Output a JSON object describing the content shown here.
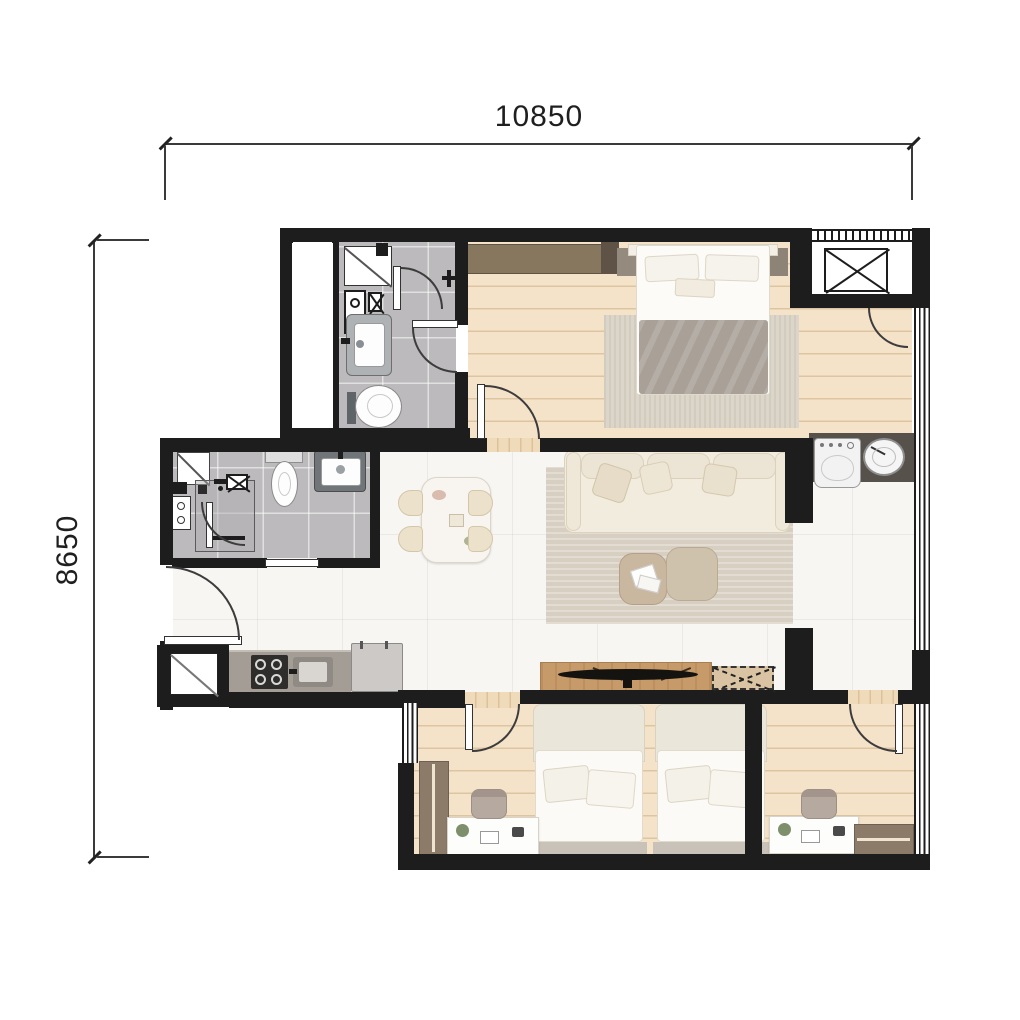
{
  "dimensions": {
    "width_label": "10850",
    "height_label": "8650"
  },
  "plan": {
    "type": "apartment-floor-plan",
    "rooms": [
      {
        "name": "master-bedroom",
        "position": "top-right",
        "floor": "wood",
        "furniture": [
          "wardrobe-with-hangers",
          "double-bed",
          "nightstand-left",
          "nightstand-right",
          "rug",
          "entry-door"
        ]
      },
      {
        "name": "bathroom-1",
        "position": "top-left",
        "floor": "grey-tile",
        "fixtures": [
          "shower-tray",
          "water-heater",
          "shut-off-valve",
          "shower-mixer",
          "wash-basin",
          "toilet",
          "inner-door",
          "entry-door",
          "service-shaft"
        ]
      },
      {
        "name": "ac-ledge",
        "position": "top-right-corner",
        "fixtures": [
          "condenser-unit-x-symbol",
          "louver-grille",
          "access-door"
        ]
      },
      {
        "name": "laundry-nook",
        "position": "right",
        "fixtures": [
          "washing-machine",
          "round-basin",
          "dark-counter"
        ]
      },
      {
        "name": "living-dining",
        "position": "center",
        "floor": "white-tile",
        "furniture": [
          "dining-table",
          "dining-chairs-x4",
          "sofa",
          "throw-pillows",
          "striped-rug",
          "ottoman-with-magazines",
          "ottoman",
          "tv-console",
          "tv",
          "future-unit-dashed-x-box"
        ]
      },
      {
        "name": "bathroom-2",
        "position": "mid-left",
        "floor": "grey-tile",
        "fixtures": [
          "glass-shower-screen",
          "shower-stall-with-door",
          "towel-bar",
          "floor-drain",
          "valve-x-symbol",
          "meter-box",
          "toilet",
          "wash-basin",
          "sliding-door"
        ]
      },
      {
        "name": "entry-kitchen-hall",
        "position": "left",
        "floor": "white-tile",
        "fixtures": [
          "entrance-door",
          "kitchen-counter",
          "cooktop-4-burners",
          "kitchen-sink",
          "refrigerator",
          "service-shaft"
        ]
      },
      {
        "name": "bedroom-2",
        "position": "bottom-left",
        "floor": "wood",
        "furniture": [
          "single-bed",
          "pillows",
          "desk",
          "plant",
          "laptop",
          "desk-chair",
          "wardrobe-with-hangers",
          "window-left",
          "entry-door"
        ]
      },
      {
        "name": "bedroom-3",
        "position": "bottom-right",
        "floor": "wood",
        "furniture": [
          "single-bed",
          "pillows",
          "desk",
          "plant",
          "laptop",
          "desk-chair",
          "wardrobe-with-hangers",
          "window-right",
          "entry-door"
        ]
      }
    ],
    "palette": {
      "wall": "#1d1d1d",
      "wood_floor": "#f4e3c9",
      "white_tile": "#f7f6f3",
      "bath_tile": "#bcbabc",
      "wardrobe": "#8b7b68",
      "laundry_counter": "#57514c",
      "kitchen_counter": "#a39d96",
      "rug": "#d7cfc1",
      "sofa": "#f2ecdf",
      "blanket": "#a9a198",
      "tv_console": "#c79a6a",
      "dimension_text": "#1f1f1f"
    }
  }
}
